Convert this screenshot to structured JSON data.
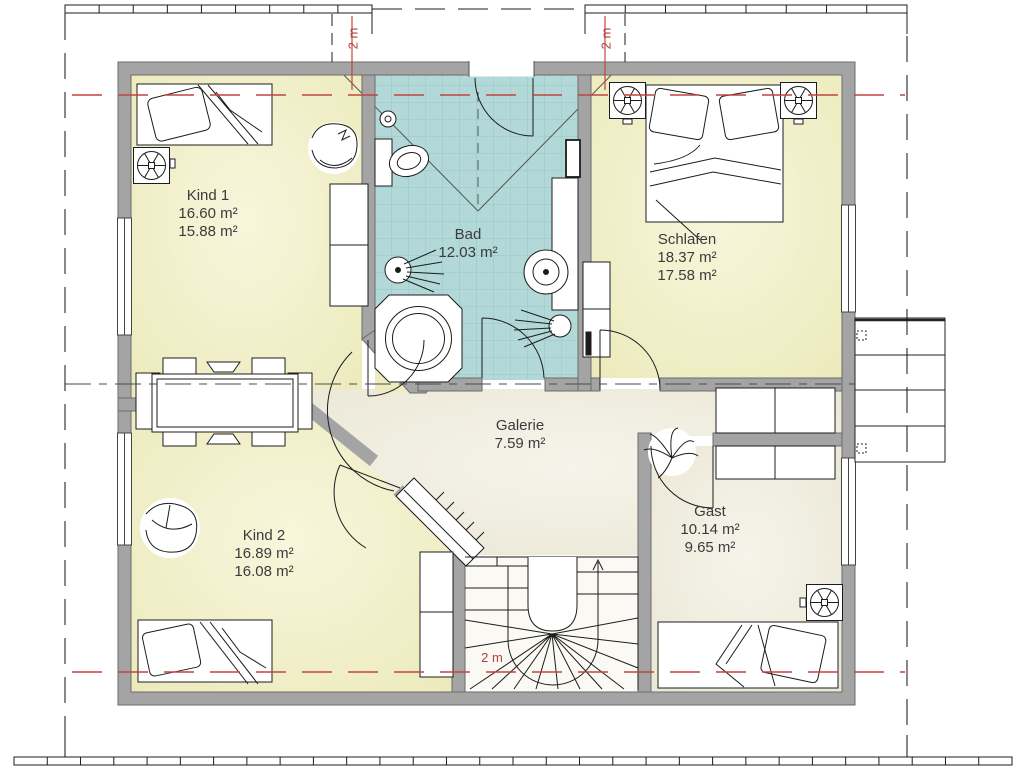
{
  "rooms": {
    "kind1": {
      "name": "Kind 1",
      "area_gross": "16.60 m²",
      "area_net": "15.88 m²"
    },
    "bad": {
      "name": "Bad",
      "area_gross": "12.03 m²"
    },
    "schlafen": {
      "name": "Schlafen",
      "area_gross": "18.37 m²",
      "area_net": "17.58 m²"
    },
    "galerie": {
      "name": "Galerie",
      "area_gross": "7.59 m²"
    },
    "gast": {
      "name": "Gast",
      "area_gross": "10.14 m²",
      "area_net": "9.65 m²"
    },
    "kind2": {
      "name": "Kind 2",
      "area_gross": "16.89 m²",
      "area_net": "16.08 m²"
    }
  },
  "dimensions": {
    "dormer_left": "2 m",
    "dormer_right": "2 m",
    "stair_headroom": "2 m"
  },
  "colors": {
    "wall": "#a4a4a4",
    "tile": "#b2d8d8",
    "tile_grid": "#96c7c7",
    "room_yellow": "#f0eec4",
    "floor_cream": "#efecdd",
    "reference_red": "#c14540"
  }
}
